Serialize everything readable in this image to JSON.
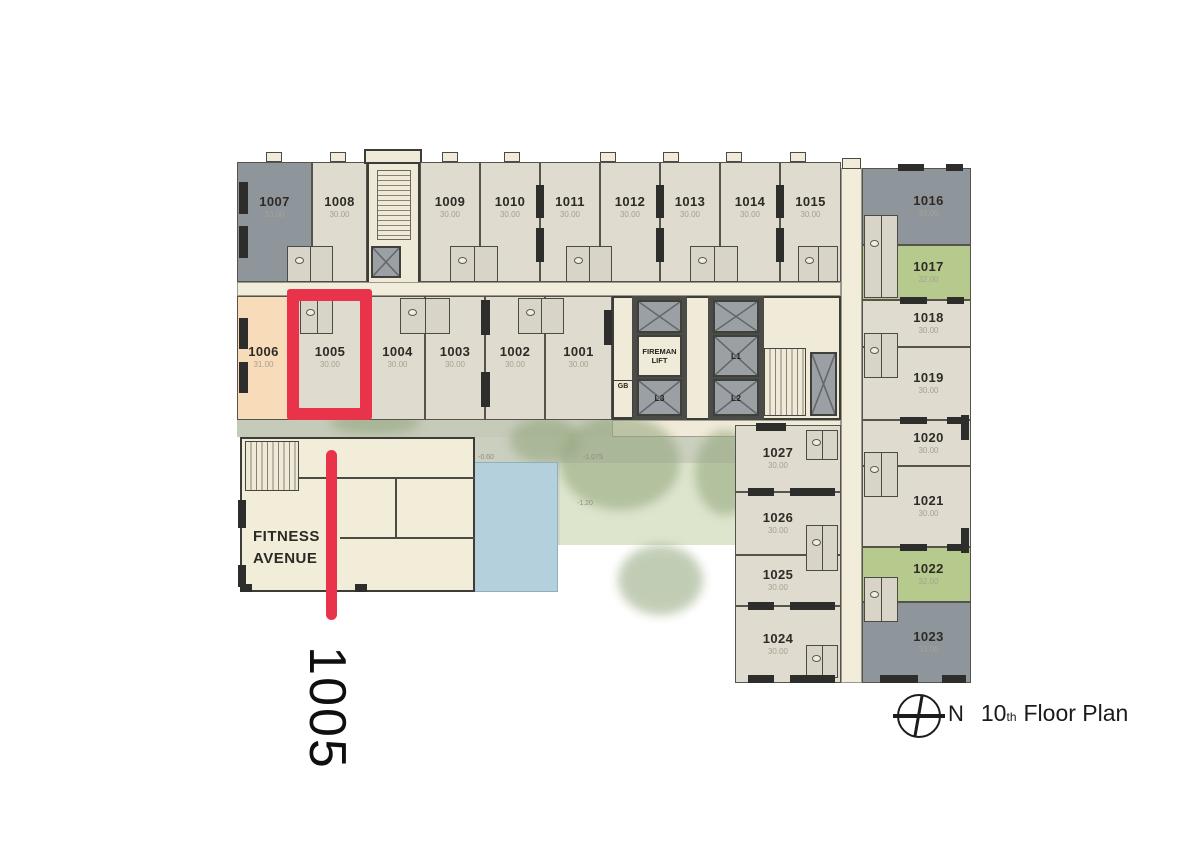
{
  "rooms": {
    "top_row": [
      {
        "number": "1007",
        "area": "33.00"
      },
      {
        "number": "1008",
        "area": "30.00"
      },
      {
        "number": "1009",
        "area": "30.00"
      },
      {
        "number": "1010",
        "area": "30.00"
      },
      {
        "number": "1011",
        "area": "30.00"
      },
      {
        "number": "1012",
        "area": "30.00"
      },
      {
        "number": "1013",
        "area": "30.00"
      },
      {
        "number": "1014",
        "area": "30.00"
      },
      {
        "number": "1015",
        "area": "30.00"
      }
    ],
    "mid_row": [
      {
        "number": "1006",
        "area": "31.00"
      },
      {
        "number": "1005",
        "area": "30.00"
      },
      {
        "number": "1004",
        "area": "30.00"
      },
      {
        "number": "1003",
        "area": "30.00"
      },
      {
        "number": "1002",
        "area": "30.00"
      },
      {
        "number": "1001",
        "area": "30.00"
      }
    ],
    "right_col": [
      {
        "number": "1016",
        "area": "33.00"
      },
      {
        "number": "1017",
        "area": "32.00"
      },
      {
        "number": "1018",
        "area": "30.00"
      },
      {
        "number": "1019",
        "area": "30.00"
      },
      {
        "number": "1020",
        "area": "30.00"
      },
      {
        "number": "1021",
        "area": "30.00"
      },
      {
        "number": "1022",
        "area": "32.00"
      },
      {
        "number": "1023",
        "area": "33.00"
      }
    ],
    "lower_mid_col": [
      {
        "number": "1027",
        "area": "30.00"
      },
      {
        "number": "1026",
        "area": "30.00"
      },
      {
        "number": "1025",
        "area": "30.00"
      },
      {
        "number": "1024",
        "area": "30.00"
      }
    ]
  },
  "core": {
    "fireman_line1": "FIREMAN",
    "fireman_line2": "LIFT",
    "l1": "L1",
    "l2": "L2",
    "l3": "L3",
    "gb": "GB"
  },
  "fitness": {
    "line1": "FITNESS",
    "line2": "AVENUE"
  },
  "courtyard": {
    "levels": [
      "-0.60",
      "-1.075",
      "-1.20"
    ]
  },
  "annotations": {
    "room_callout": "1005",
    "highlight_color": "#e8334a"
  },
  "compass": {
    "north": "N",
    "floor_number": "10",
    "ordinal_suffix": "th",
    "label": "Floor Plan"
  },
  "colors": {
    "standard_room": "#dfdbcf",
    "corridor": "#f2edda",
    "gray_room": "#8e959b",
    "green_room": "#b6ca8e",
    "peach_room": "#f8dbb9",
    "wall": "#3c3c38",
    "pool": "#b5d0dd",
    "annotation_red": "#e8334a"
  }
}
